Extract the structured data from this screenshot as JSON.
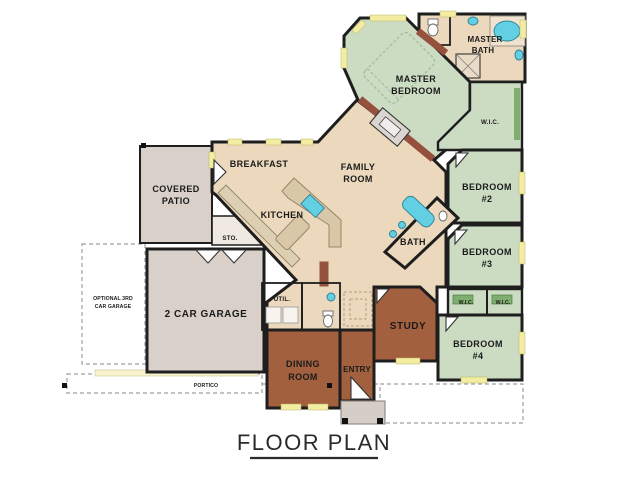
{
  "title": "FLOOR PLAN",
  "rooms": {
    "master_bath": {
      "l1": "MASTER",
      "l2": "BATH"
    },
    "master_bedroom": {
      "l1": "MASTER",
      "l2": "BEDROOM"
    },
    "wic_master": "W.I.C.",
    "bedroom2": {
      "l1": "BEDROOM",
      "l2": "#2"
    },
    "bedroom3": {
      "l1": "BEDROOM",
      "l2": "#3"
    },
    "bedroom4": {
      "l1": "BEDROOM",
      "l2": "#4"
    },
    "wic_left": "W.I.C.",
    "wic_right": "W.I.C.",
    "bath": "BATH",
    "family": {
      "l1": "FAMILY",
      "l2": "ROOM"
    },
    "breakfast": "BREAKFAST",
    "kitchen": "KITCHEN",
    "storage": "STO.",
    "utility": "UTIL.",
    "covered_patio": {
      "l1": "COVERED",
      "l2": "PATIO"
    },
    "garage": "2 CAR GARAGE",
    "optional_garage": {
      "l1": "OPTIONAL 3RD",
      "l2": "CAR GARAGE"
    },
    "dining": {
      "l1": "DINING",
      "l2": "ROOM"
    },
    "entry": "ENTRY",
    "study": "STUDY",
    "portico": "PORTICO"
  },
  "colors": {
    "floor_tan": "#ecd9bd",
    "bedroom_green": "#cbdcc3",
    "accent_brown": "#a2603e",
    "garage_gray": "#d8d0c9",
    "window_yellow": "#f2eda0",
    "fixture_cyan": "#62cfe2",
    "wood_red": "#96503e",
    "counter_tan": "#d8c8a8",
    "wall_black": "#1e1e1e"
  }
}
